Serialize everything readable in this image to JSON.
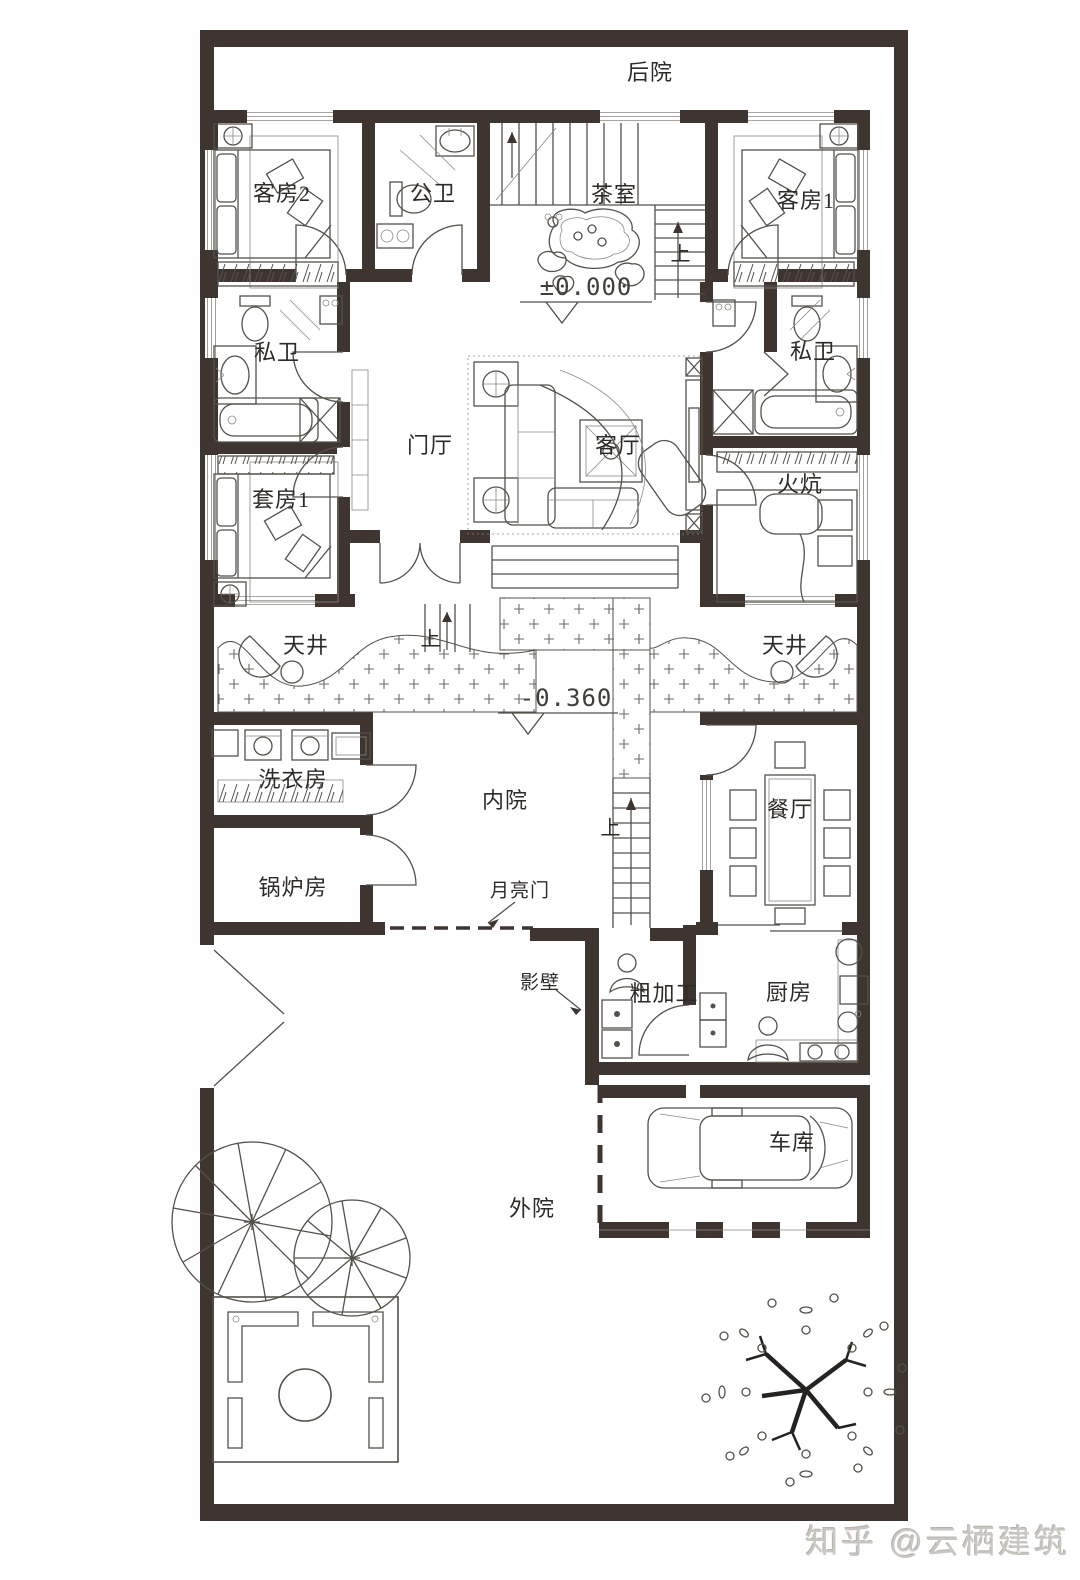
{
  "colors": {
    "wall": "#3e3531",
    "line": "#55504a",
    "hatch": "#6e6963",
    "watermark": "#c9c5c1"
  },
  "plan_labels": {
    "backyard": "后院",
    "guest_room_2": "客房2",
    "public_bathroom": "公卫",
    "tea_room": "茶室",
    "guest_room_1": "客房1",
    "private_bathroom_left": "私卫",
    "private_bathroom_right": "私卫",
    "entry_hall": "门厅",
    "living_room": "客厅",
    "kang_room": "火炕",
    "suite_1": "套房1",
    "light_well_left": "天井",
    "light_well_right": "天井",
    "laundry_room": "洗衣房",
    "inner_courtyard": "内院",
    "dining_room": "餐厅",
    "boiler_room": "锅炉房",
    "moon_gate": "月亮门",
    "screen_wall": "影壁",
    "rough_prep": "粗加工",
    "kitchen": "厨房",
    "garage": "车库",
    "outer_courtyard": "外院"
  },
  "annotations": {
    "elevation_zero": "±0.000",
    "elevation_negative": "-0.360",
    "stair_up_main": "上",
    "stair_up_steps": "上",
    "stair_up_courtyard": "上"
  },
  "watermark_text": "知乎 @云栖建筑"
}
